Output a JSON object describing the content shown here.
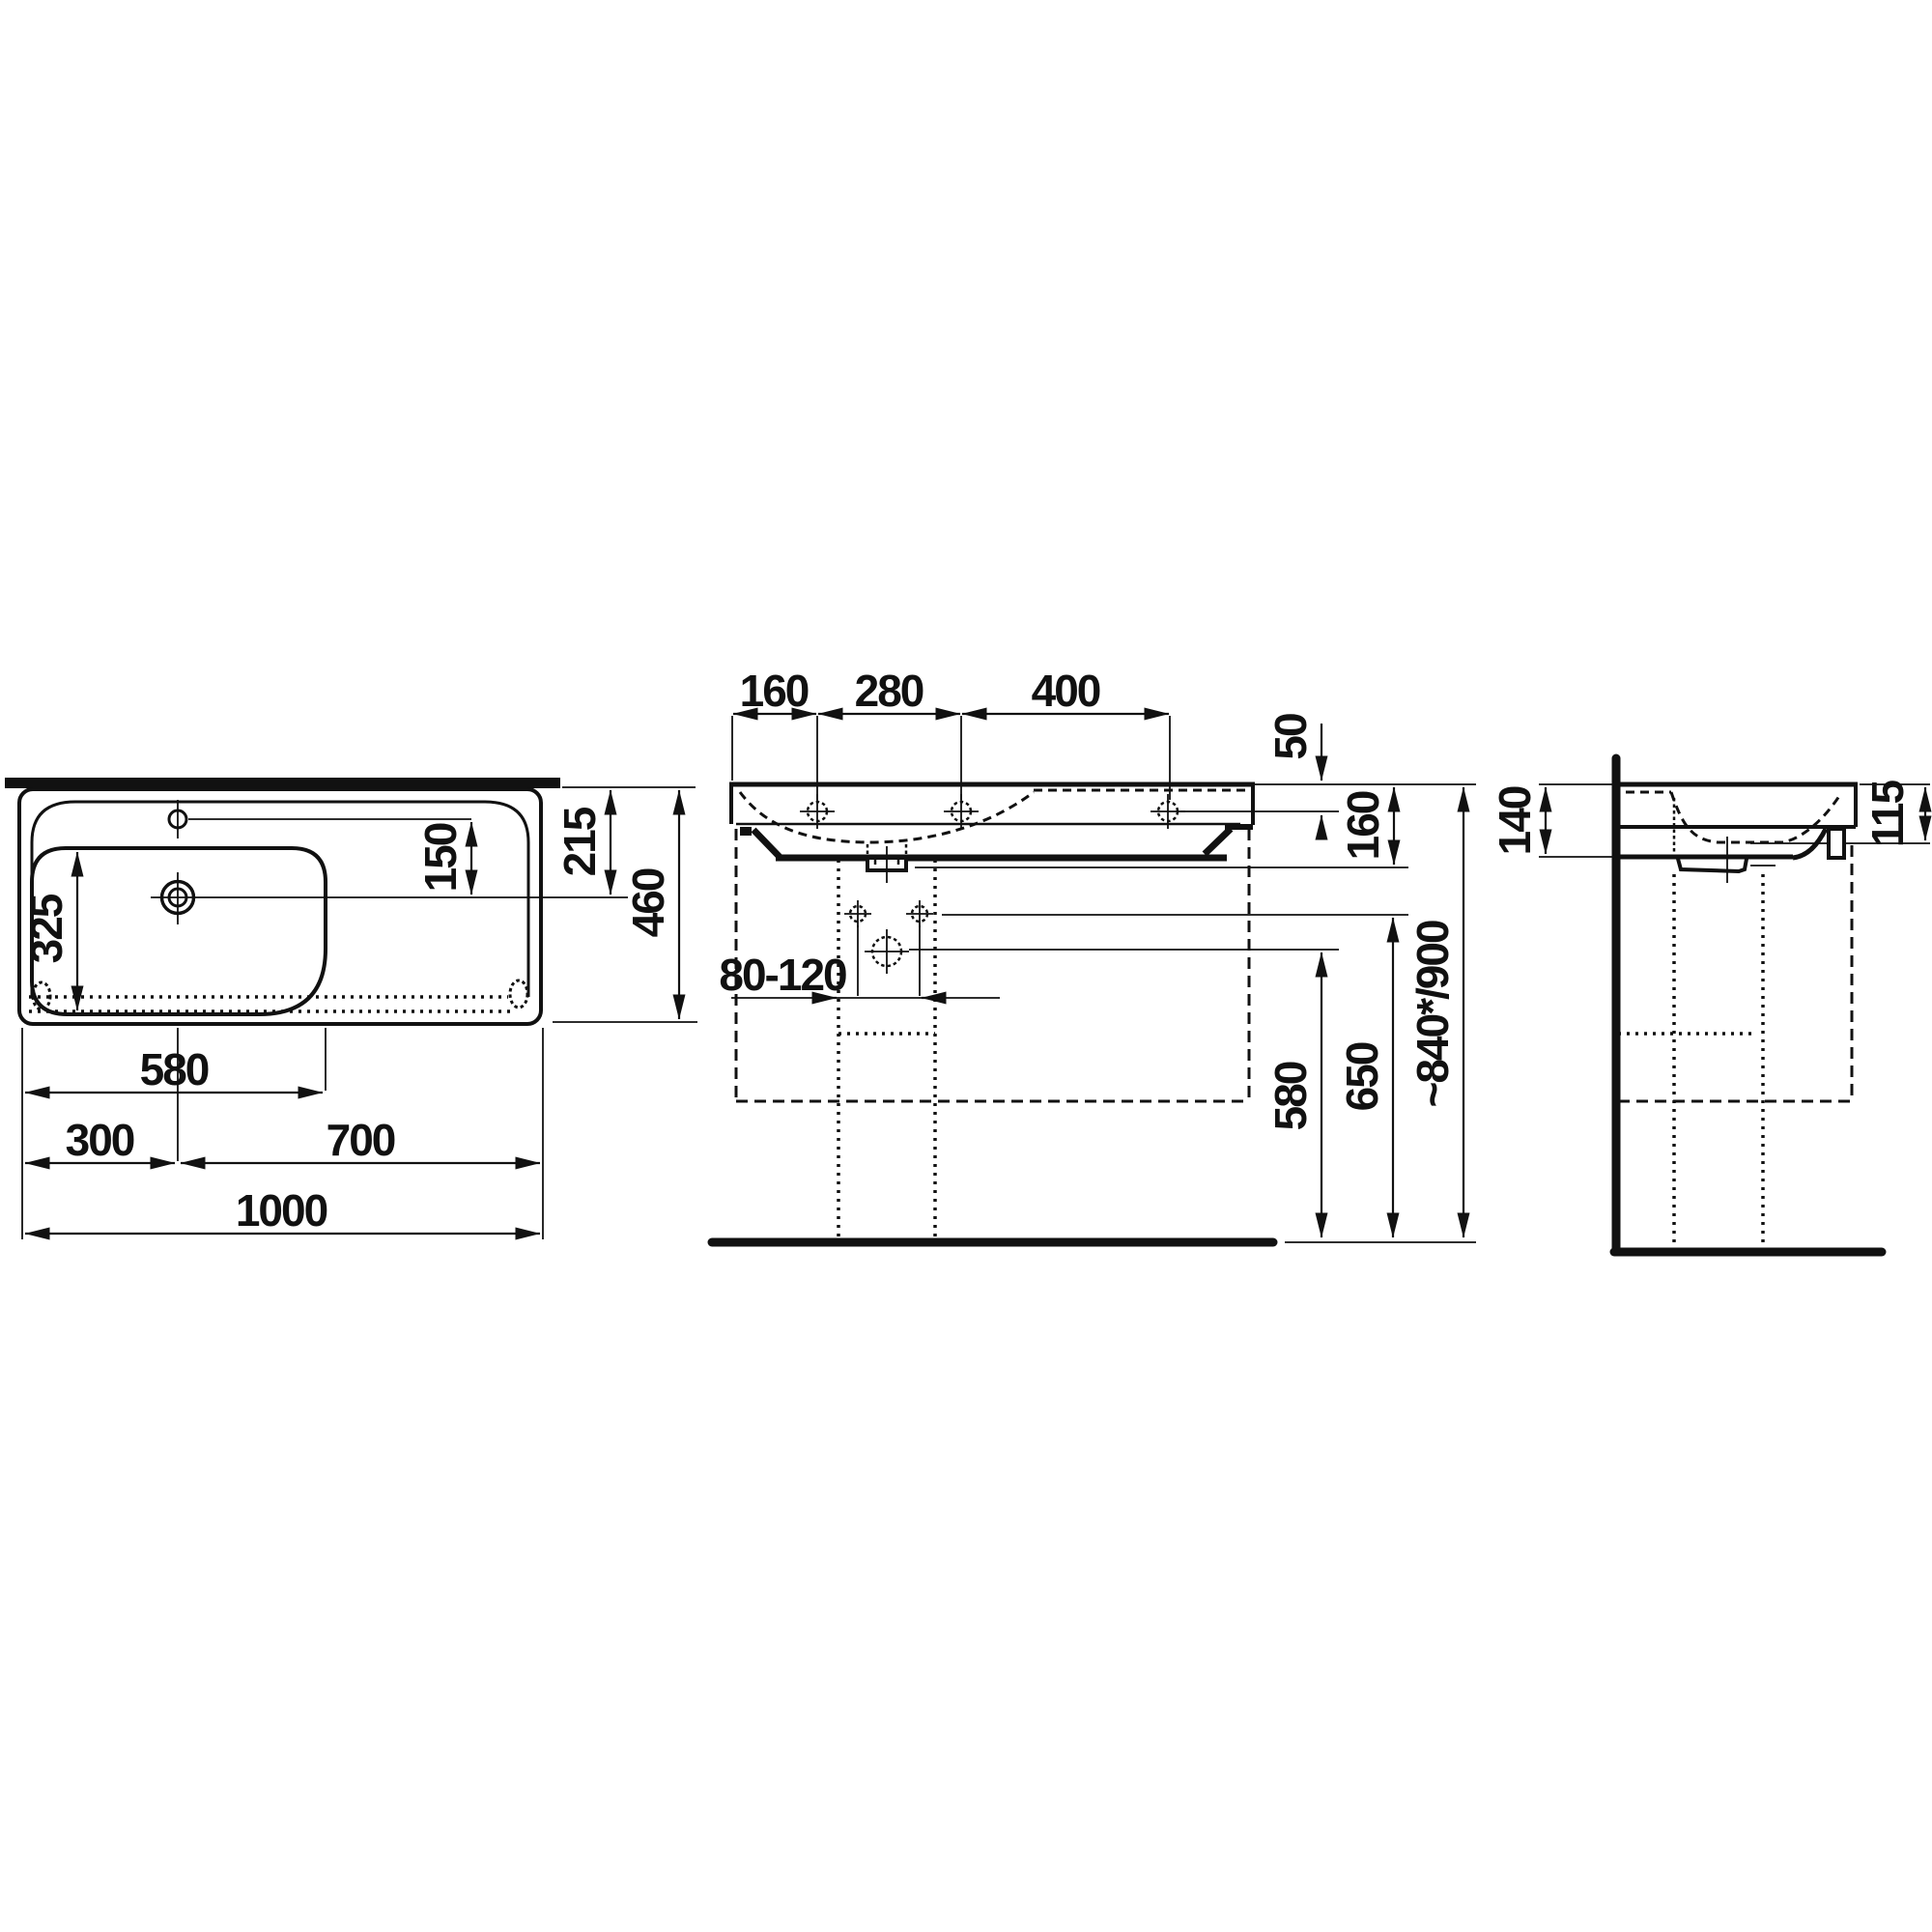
{
  "drawing_type": "technical dimension drawing",
  "subject": "wall-mounted washbasin with left-hand bowl, three orthographic views",
  "units": "mm",
  "colors": {
    "line": "#111111",
    "background": "#ffffff"
  },
  "views": {
    "plan": {
      "name": "top view",
      "dims": {
        "faucet_to_drain": "150",
        "bowl_length": "325",
        "drain_from_back": "215",
        "total_depth": "460",
        "bowl_width": "580",
        "drain_from_left": "300",
        "drain_to_right": "700",
        "total_width": "1000"
      }
    },
    "front": {
      "name": "front view",
      "dims": {
        "edge_to_first_hole": "160",
        "first_to_second_hole": "280",
        "second_to_third_hole": "400",
        "rim_to_hole": "50",
        "rim_to_trap": "160",
        "bolt_spacing": "80-120",
        "floor_to_drain": "580",
        "floor_to_bolts": "650",
        "floor_to_rim": "~840*/900"
      }
    },
    "side": {
      "name": "side view",
      "dims": {
        "body_height": "140",
        "front_edge_height": "115"
      }
    }
  }
}
